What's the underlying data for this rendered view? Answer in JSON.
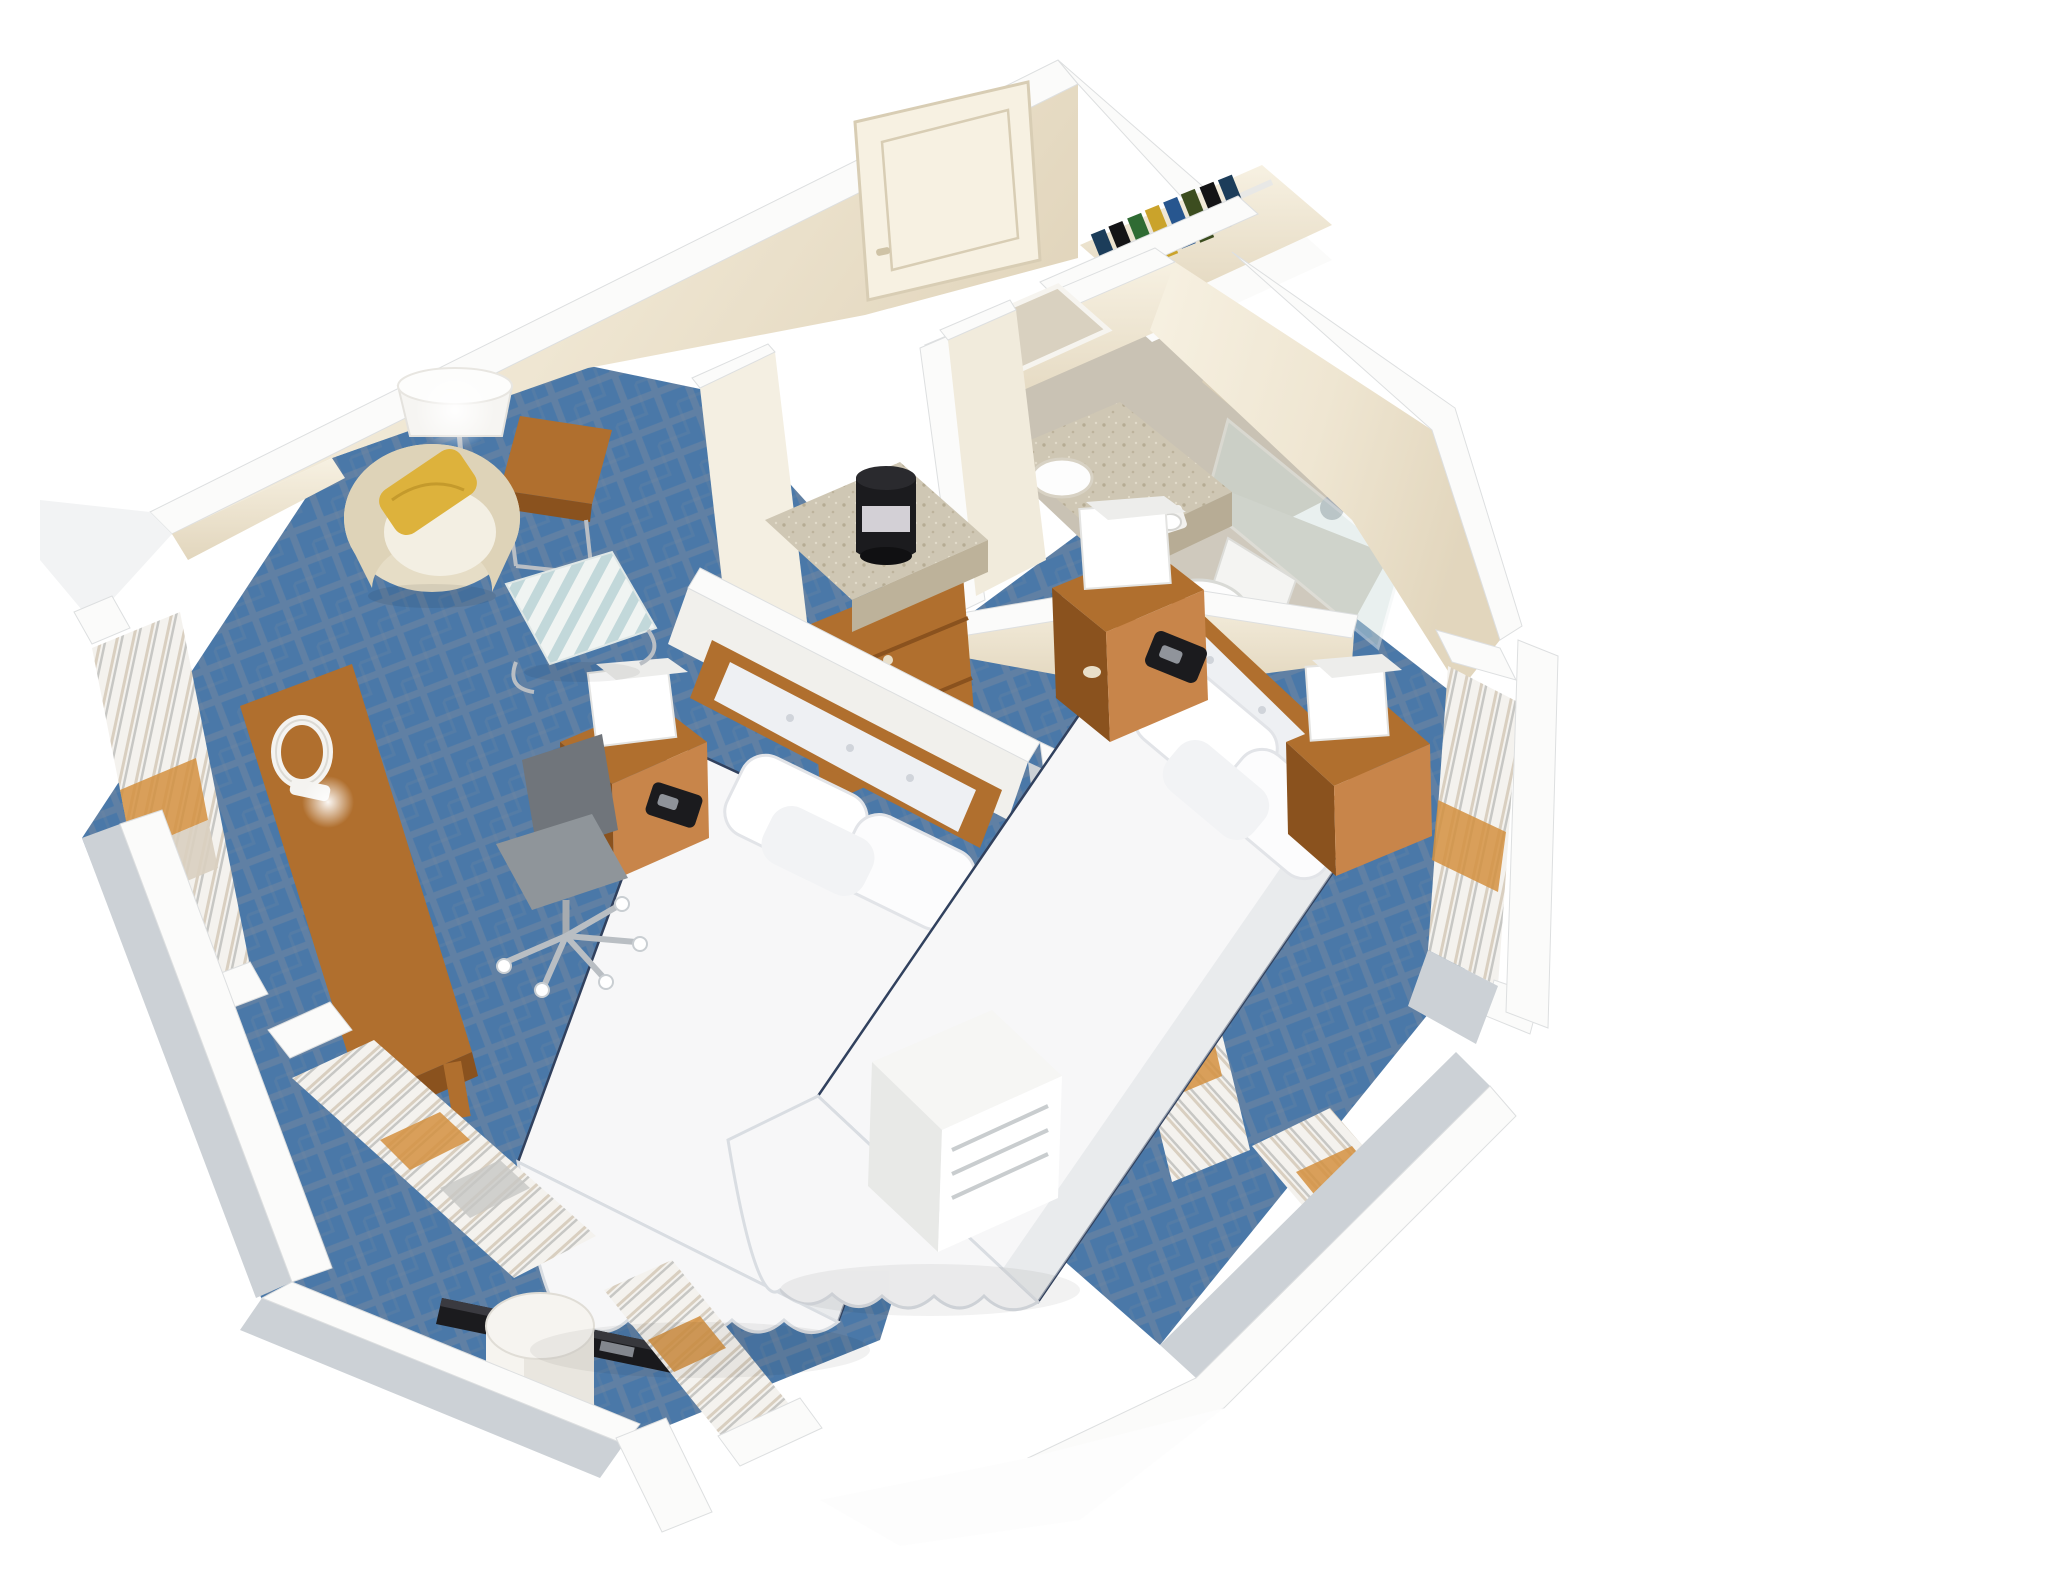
{
  "meta": {
    "title": "Isometric 3D cutaway rendering of a two-bedroom hotel suite floor plan",
    "view": "top-down isometric cutaway",
    "background": "#ffffff",
    "text_on_image": "none"
  },
  "palette": {
    "wall-cream": "#efe6d2",
    "wall-cream-dark": "#e2d6bd",
    "wall-cream-light": "#f7f1e2",
    "wall-cap": "#fbfbfa",
    "cap-edge": "#dddfe0",
    "cut-grey": "#ccd1d6",
    "carpet-blue": "#4a78a8",
    "carpet-lattice": "#7587a0",
    "bath-floor": "#c9c2b4",
    "granite": "#cfc7b4",
    "granite-dot": "#b0a58c",
    "shower-marble": "#d8cdb6",
    "glass": "#cfe0dd",
    "wood": "#b06f2e",
    "wood-dark": "#8a521e",
    "wood-light": "#c8854a",
    "white-furn": "#f4f3f0",
    "bed-white": "#f7f7f8",
    "bed-shadow": "#dfe2e6",
    "piping-navy": "#31415e",
    "tufted-panel": "#eef0f3",
    "pillow-yellow": "#ddb23c",
    "ottoman-stripe-a": "#c2d8da",
    "ottoman-stripe-b": "#f0f4f2",
    "chair-grey": "#8f959a",
    "chair-grey-dark": "#70757b",
    "curtain-orange": "#d3913f",
    "curtain-tan": "#d9cfc0",
    "curtain-white": "#f4f2ee",
    "curtain-grey": "#c7c7c4",
    "appliance-black": "#1b1b1e",
    "chrome": "#b9bec4",
    "porcelain": "#fdfdfd"
  },
  "scene": {
    "rooms": [
      {
        "id": "bedroom-living",
        "name": "left bedroom / living area",
        "floor": "blue lattice-patterned carpet",
        "items": [
          "entry-door",
          "floor-lamp",
          "side-table",
          "barrel-armchair",
          "yellow-lumbar-pillow",
          "striped-ottoman",
          "work-desk",
          "desk-lamp",
          "office-chair",
          "queen-bed-1",
          "tufted-headboard-1",
          "nightstand-1",
          "cube-lamp-1",
          "telephone-1",
          "flat-tv",
          "round-table",
          "window-curtains-west",
          "window-curtains-south"
        ]
      },
      {
        "id": "vanity-nook",
        "name": "vanity / dressing nook",
        "items": [
          "granite-counter",
          "ice-bucket",
          "wood-dresser",
          "mirror-partition-walls"
        ]
      },
      {
        "id": "closet",
        "name": "open closet",
        "items": [
          "closet-rod",
          "hanging-clothes"
        ]
      },
      {
        "id": "bathroom",
        "name": "bathroom",
        "floor": "stone tile",
        "items": [
          "vanity-sink",
          "granite-bath-counter",
          "wall-mirror",
          "toilet",
          "toilet-paper-holder",
          "shower-marble-wall",
          "shower-glass-panel",
          "shower-fixtures"
        ]
      },
      {
        "id": "bedroom-2",
        "name": "right bedroom",
        "floor": "blue lattice-patterned carpet",
        "items": [
          "queen-bed-2",
          "tufted-headboard-2",
          "nightstand-2",
          "cube-lamp-2",
          "telephone-2",
          "nightstand-3",
          "cube-lamp-3",
          "ptac-unit",
          "window-curtains-east",
          "window-curtains-southeast",
          "divider-curtains"
        ]
      }
    ],
    "clothes_colors": [
      "#1c3d5a",
      "#2f6b33",
      "#141416",
      "#caa32b",
      "#27568f",
      "#3c4d1f"
    ]
  }
}
